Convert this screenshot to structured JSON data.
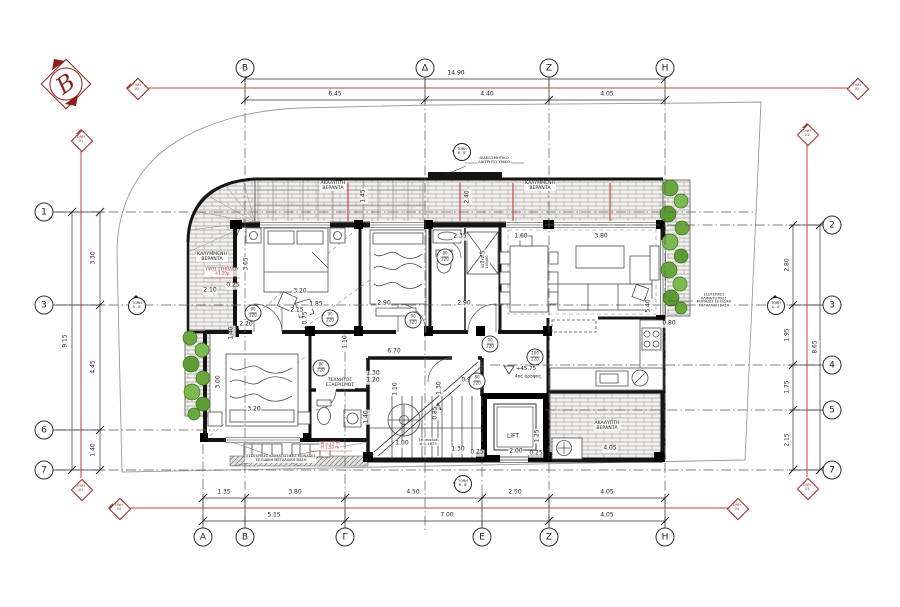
{
  "north": {
    "label": "B"
  },
  "grid": {
    "top": [
      {
        "label": "Β",
        "x": 245,
        "y": 68
      },
      {
        "label": "Δ",
        "x": 425,
        "y": 68
      },
      {
        "label": "Ζ",
        "x": 549,
        "y": 68
      },
      {
        "label": "Η",
        "x": 665,
        "y": 68
      }
    ],
    "bottom": [
      {
        "label": "Α",
        "x": 203,
        "y": 537
      },
      {
        "label": "Β",
        "x": 245,
        "y": 537
      },
      {
        "label": "Γ",
        "x": 345,
        "y": 537
      },
      {
        "label": "Ε",
        "x": 482,
        "y": 537
      },
      {
        "label": "Ζ",
        "x": 549,
        "y": 537
      },
      {
        "label": "Η",
        "x": 665,
        "y": 537
      }
    ],
    "left": [
      {
        "label": "1",
        "x": 44,
        "y": 212
      },
      {
        "label": "3",
        "x": 44,
        "y": 305
      },
      {
        "label": "6",
        "x": 44,
        "y": 430
      },
      {
        "label": "7",
        "x": 44,
        "y": 470
      }
    ],
    "right": [
      {
        "label": "2",
        "x": 832,
        "y": 225
      },
      {
        "label": "3",
        "x": 832,
        "y": 305
      },
      {
        "label": "4",
        "x": 832,
        "y": 365
      },
      {
        "label": "5",
        "x": 832,
        "y": 410
      },
      {
        "label": "7",
        "x": 832,
        "y": 470
      }
    ]
  },
  "dims": {
    "perimeter_top": [
      {
        "t": "14.90",
        "x": 456,
        "y": 74
      },
      {
        "t": "6.45",
        "x": 335,
        "y": 95
      },
      {
        "t": "4.40",
        "x": 487,
        "y": 95
      },
      {
        "t": "4.05",
        "x": 607,
        "y": 95
      }
    ],
    "perimeter_bottom": [
      {
        "t": "1.35",
        "x": 224,
        "y": 493
      },
      {
        "t": "3.80",
        "x": 295,
        "y": 493
      },
      {
        "t": "4.50",
        "x": 413,
        "y": 493
      },
      {
        "t": "2.50",
        "x": 515,
        "y": 493
      },
      {
        "t": "4.05",
        "x": 607,
        "y": 493
      },
      {
        "t": "5.15",
        "x": 274,
        "y": 516
      },
      {
        "t": "7.00",
        "x": 447,
        "y": 516
      },
      {
        "t": "4.05",
        "x": 607,
        "y": 516
      }
    ],
    "perimeter_left": [
      {
        "t": "9.15",
        "x": 66,
        "y": 341,
        "r": 1
      },
      {
        "t": "3.30",
        "x": 94,
        "y": 258,
        "r": 1
      },
      {
        "t": "4.45",
        "x": 94,
        "y": 367,
        "r": 1
      },
      {
        "t": "1.40",
        "x": 94,
        "y": 450,
        "r": 1
      }
    ],
    "perimeter_right": [
      {
        "t": "2.80",
        "x": 788,
        "y": 265,
        "r": 1
      },
      {
        "t": "1.95",
        "x": 788,
        "y": 335,
        "r": 1
      },
      {
        "t": "1.75",
        "x": 788,
        "y": 387,
        "r": 1
      },
      {
        "t": "2.15",
        "x": 788,
        "y": 440,
        "r": 1
      },
      {
        "t": "8.65",
        "x": 816,
        "y": 347,
        "r": 1
      }
    ],
    "interior": [
      {
        "t": "3.20",
        "x": 300,
        "y": 292
      },
      {
        "t": "1.85",
        "x": 316,
        "y": 305
      },
      {
        "t": "2.90",
        "x": 384,
        "y": 304
      },
      {
        "t": "2.90",
        "x": 464,
        "y": 304
      },
      {
        "t": "3.65",
        "x": 247,
        "y": 264,
        "r": 1
      },
      {
        "t": "2.10",
        "x": 210,
        "y": 291
      },
      {
        "t": "0.25",
        "x": 233,
        "y": 286
      },
      {
        "t": "2.15",
        "x": 297,
        "y": 311
      },
      {
        "t": "0.75",
        "x": 306,
        "y": 318,
        "r": 1
      },
      {
        "t": "1.10",
        "x": 346,
        "y": 342,
        "r": 1
      },
      {
        "t": "6.70",
        "x": 394,
        "y": 352
      },
      {
        "t": "2.35",
        "x": 460,
        "y": 237
      },
      {
        "t": "1.45",
        "x": 484,
        "y": 257,
        "r": 1
      },
      {
        "t": "1.60",
        "x": 521,
        "y": 237
      },
      {
        "t": "3.80",
        "x": 601,
        "y": 237
      },
      {
        "t": "2.40",
        "x": 468,
        "y": 197,
        "r": 1
      },
      {
        "t": "1.45",
        "x": 364,
        "y": 196,
        "r": 1
      },
      {
        "t": "5.40",
        "x": 649,
        "y": 306,
        "r": 1
      },
      {
        "t": "0.80",
        "x": 669,
        "y": 324
      },
      {
        "t": "3.00",
        "x": 219,
        "y": 382,
        "r": 1
      },
      {
        "t": "3.20",
        "x": 254,
        "y": 410
      },
      {
        "t": "1.40",
        "x": 232,
        "y": 333,
        "r": 1
      },
      {
        "t": "2.20",
        "x": 246,
        "y": 325
      },
      {
        "t": "1.30",
        "x": 373,
        "y": 374
      },
      {
        "t": "1.20",
        "x": 373,
        "y": 381
      },
      {
        "t": "1.10",
        "x": 396,
        "y": 389,
        "r": 1
      },
      {
        "t": "1.30",
        "x": 440,
        "y": 388,
        "r": 1
      },
      {
        "t": "0.90",
        "x": 468,
        "y": 381
      },
      {
        "t": "1.40",
        "x": 367,
        "y": 417,
        "r": 1
      },
      {
        "t": "0.85",
        "x": 436,
        "y": 413,
        "r": 1
      },
      {
        "t": "1.00",
        "x": 402,
        "y": 444
      },
      {
        "t": "1.30",
        "x": 458,
        "y": 450
      },
      {
        "t": "0.25",
        "x": 477,
        "y": 453
      },
      {
        "t": "2.00",
        "x": 516,
        "y": 452
      },
      {
        "t": "0.25",
        "x": 536,
        "y": 454
      },
      {
        "t": "4.05",
        "x": 610,
        "y": 449
      },
      {
        "t": "1.25",
        "x": 538,
        "y": 436,
        "r": 1
      }
    ]
  },
  "rooms": [
    {
      "t": "ΑΚΑΛΥΠΤΗ\nΒΕΡΑΝΤΑ",
      "x": 333,
      "y": 186,
      "s": 4.6
    },
    {
      "t": "ΚΑΛΥΜΜΕΝΗ\nΒΕΡΑΝΤΑ",
      "x": 540,
      "y": 186,
      "s": 4.6
    },
    {
      "t": "ΚΑΛΥΜΜΕΝΗ\nΒΕΡΑΝΤΑ",
      "x": 212,
      "y": 257,
      "s": 4.6
    },
    {
      "t": "ΥΨΟΣ ΣΤΗΘΑΙΟΥ\n+1.20μ",
      "x": 222,
      "y": 272,
      "s": 4,
      "c": "red"
    },
    {
      "t": "ΑΚΑΛΥΠΤΗ\nΒΕΡΑΝΤΑ",
      "x": 607,
      "y": 426,
      "s": 4.6
    },
    {
      "t": "LIFT",
      "x": 513,
      "y": 437,
      "s": 6
    },
    {
      "t": "ΤΕΧΝΗΤΟΣ\nΕΞΑΕΡΙΣΜΟΣ",
      "x": 340,
      "y": 384,
      "s": 4.4
    },
    {
      "t": "+45.75",
      "x": 526,
      "y": 369,
      "s": 5.5
    },
    {
      "t": "4ος όροφος",
      "x": 528,
      "y": 378,
      "s": 4.5
    }
  ],
  "notes": [
    {
      "t": "ΔΙΑΚΟΣΜΗΤΙΚΟ\nΔΙΑΤΡΗΤΟ ΥΛΙΚΟ",
      "x": 494,
      "y": 160,
      "s": 3.8
    },
    {
      "t": "16 σκαλιά\n≠ 0.1875",
      "x": 428,
      "y": 442,
      "s": 3.8
    },
    {
      "t": "ΝΤΟΥΖ\n145x80",
      "x": 486,
      "y": 262,
      "s": 3.5,
      "r": 1
    },
    {
      "t": "ΕΣΩΤΕΡΙΚΕΣ ΚΛΙΜΑΤΙΣΤΙΚΕΣ ΜΟΝΑΔΕΣ\nΣΕ ΕΙΔΙΚΗ ΜΕΤΑΛΛΙΚΗ ΒΑΣΗ",
      "x": 281,
      "y": 459,
      "s": 3.6
    },
    {
      "t": "W 1.15 m\nH 1.50 m",
      "x": 330,
      "y": 446,
      "s": 4,
      "c": "red"
    },
    {
      "t": "ΕΣΩΤΕΡΙΚΕΣ\nΚΛΙΜΑΤΙΣΤΙΚΕΣ\nΜΟΝΑΔΕΣ ΣΕ ΕΙΔΙΚΗ\nΜΕΤΑΛΛΙΚΗ ΒΑΣΗ",
      "x": 714,
      "y": 301,
      "s": 3.4
    }
  ],
  "door_tags": [
    {
      "a": "90",
      "b": "220",
      "x": 253,
      "y": 313
    },
    {
      "a": "90",
      "b": "220",
      "x": 330,
      "y": 318
    },
    {
      "a": "90",
      "b": "220",
      "x": 413,
      "y": 320
    },
    {
      "a": "90",
      "b": "220",
      "x": 490,
      "y": 344
    },
    {
      "a": "80",
      "b": "220",
      "x": 321,
      "y": 368
    },
    {
      "a": "80",
      "b": "220",
      "x": 477,
      "y": 381
    },
    {
      "a": "80",
      "b": "220",
      "x": 445,
      "y": 257
    },
    {
      "a": "100",
      "b": "220",
      "x": 535,
      "y": 357
    }
  ],
  "markers": {
    "elevation": [
      {
        "label": "ΟΨΗ",
        "num": "01",
        "x": 81,
        "y": 140,
        "wing": "u"
      },
      {
        "label": "ΟΨΗ",
        "num": "01",
        "x": 81,
        "y": 489,
        "wing": "d"
      },
      {
        "label": "ΟΨΗ",
        "num": "02",
        "x": 137,
        "y": 88,
        "wing": "l"
      },
      {
        "label": "ΟΨΗ",
        "num": "02",
        "x": 857,
        "y": 88,
        "wing": "r"
      },
      {
        "label": "ΟΨΗ",
        "num": "03",
        "x": 807,
        "y": 134,
        "wing": "u"
      },
      {
        "label": "ΟΨΗ",
        "num": "03",
        "x": 807,
        "y": 488,
        "wing": "d"
      },
      {
        "label": "ΟΨΗ",
        "num": "04",
        "x": 119,
        "y": 508,
        "wing": "l"
      },
      {
        "label": "ΟΨΗ",
        "num": "04",
        "x": 737,
        "y": 508,
        "wing": "r"
      }
    ],
    "section": [
      {
        "label": "ΤΟΜΗ",
        "name": "Β - Β'",
        "x": 458,
        "y": 151,
        "dir": "left"
      },
      {
        "label": "ΤΟΜΗ",
        "name": "Α - Α'",
        "x": 136,
        "y": 301,
        "dir": "up"
      },
      {
        "label": "ΤΟΜΗ",
        "name": "Α - Α'",
        "x": 775,
        "y": 301,
        "dir": "up"
      },
      {
        "label": "ΤΟΜΗ",
        "name": "Β - Β'",
        "x": 459,
        "y": 483,
        "dir": "left"
      }
    ]
  }
}
